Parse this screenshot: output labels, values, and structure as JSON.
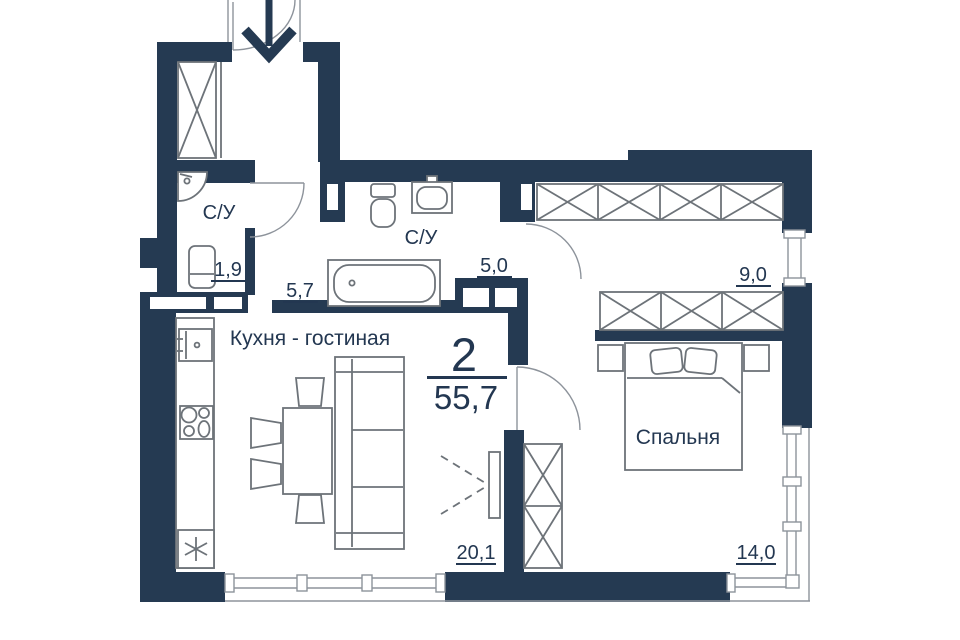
{
  "plan_type": "apartment-floor-plan",
  "labels": {
    "bathroom_small": {
      "name": "С/У",
      "area": "1,9"
    },
    "hallway": {
      "area": "5,7"
    },
    "bathroom_big": {
      "name": "С/У",
      "area": "5,0"
    },
    "dressing": {
      "area": "9,0"
    },
    "kitchen_living": {
      "name": "Кухня - гостиная",
      "area": "20,1"
    },
    "bedroom": {
      "name": "Спальня",
      "area": "14,0"
    },
    "summary": {
      "rooms_count": "2",
      "total_area": "55,7"
    }
  },
  "colors": {
    "wall": "#253a52",
    "ink": "#233751",
    "furniture_outline": "#6d7379",
    "window_line": "#8d939b",
    "background": "#ffffff"
  }
}
